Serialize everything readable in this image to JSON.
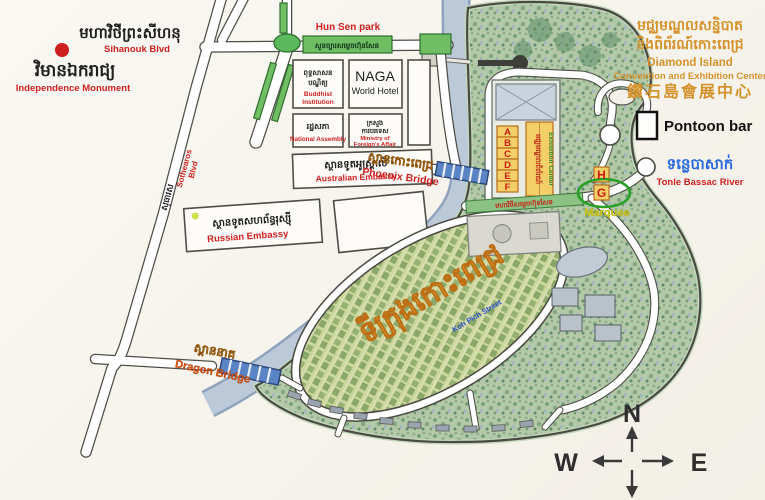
{
  "map_title": "Diamond Island (Koh Pich) tourist map",
  "colors": {
    "paper": "#f6f3ec",
    "island_green": "#b2c8a6",
    "river_blue": "#bcc9d9",
    "accent_red": "#cf1f1f",
    "accent_gold": "#d4922a",
    "hall_yellow": "#f4cf68",
    "marquee_yellow": "#ddd31e",
    "river_label_blue": "#2a6ae0"
  },
  "labels": {
    "sihanouk_khmer": "មហាវិថីព្រះសីហនុ",
    "sihanouk_en": "Sihanouk Blvd",
    "independence_khmer": "វិមានឯករាជ្យ",
    "independence_en": "Independence Monument",
    "hun_sen_park": "Hun Sen park",
    "hun_sen_park_khmer": "សួនច្បារសម្តេចហ៊ុនសែន",
    "buddhist_khmer": [
      "ពុទ្ធសាសន",
      "បណ្ឌិត្យ"
    ],
    "buddhist_en": [
      "Buddhist",
      "Institution"
    ],
    "naga_line1": "NAGA",
    "naga_line2": "World Hotel",
    "assembly_khmer": "រដ្ឋសភា",
    "assembly_en": "National Assembly",
    "ministry_khmer": [
      "ក្រសួង",
      "ការបរទេស"
    ],
    "ministry_en": [
      "Ministry of",
      "Foreign's Affair"
    ],
    "australian_khmer": "ស្ថានទូតអូស្ត្រាលី",
    "australian_en": "Australian Embassy",
    "russian_khmer": "ស្ថានទូតសហព័ន្ធរុស្ស៊ី",
    "russian_en": "Russian Embassy",
    "sothearos_khmer": "សុធារស",
    "sothearos_en": [
      "Sothearos",
      "Blvd"
    ],
    "phoenix_khmer": "ស្ពានកោះពេជ្រ",
    "phoenix_en": "Phoenix Bridge",
    "dragon_khmer": "ស្ពាននាគ",
    "dragon_en": "Dragon Bridge",
    "header_khmer1": "មជ្ឈមណ្ឌលសន្និបាត",
    "header_khmer2": "និងពិព័រណ៍កោះពេជ្រ",
    "header_en1": "Diamond Island",
    "header_en2": "Convention and Exhibition Center",
    "header_cn": "鑽石島會展中心",
    "pontoon_bar": "Pontoon bar",
    "river_khmer": "ទន្លេបាសាក់",
    "river_en": "Tonle Bassac River",
    "halls": [
      "A",
      "B",
      "C",
      "D",
      "E",
      "F"
    ],
    "hall_h": "H",
    "hall_g": "G",
    "marquee": "Marquee",
    "exhibition_khmer": "មជ្ឈមណ្ឌលពិព័រណ៍",
    "exhibition_en": "Exhibition Center",
    "banner_khmer": "មហាវិថីសម្តេចហ៊ុនសែន",
    "city_khmer": "ទីក្រុងកោះពេជ្រ",
    "koh_pich_street": "Koh Pich Street",
    "compass_n": "N",
    "compass_e": "E",
    "compass_w": "W",
    "compass_s": "S"
  }
}
